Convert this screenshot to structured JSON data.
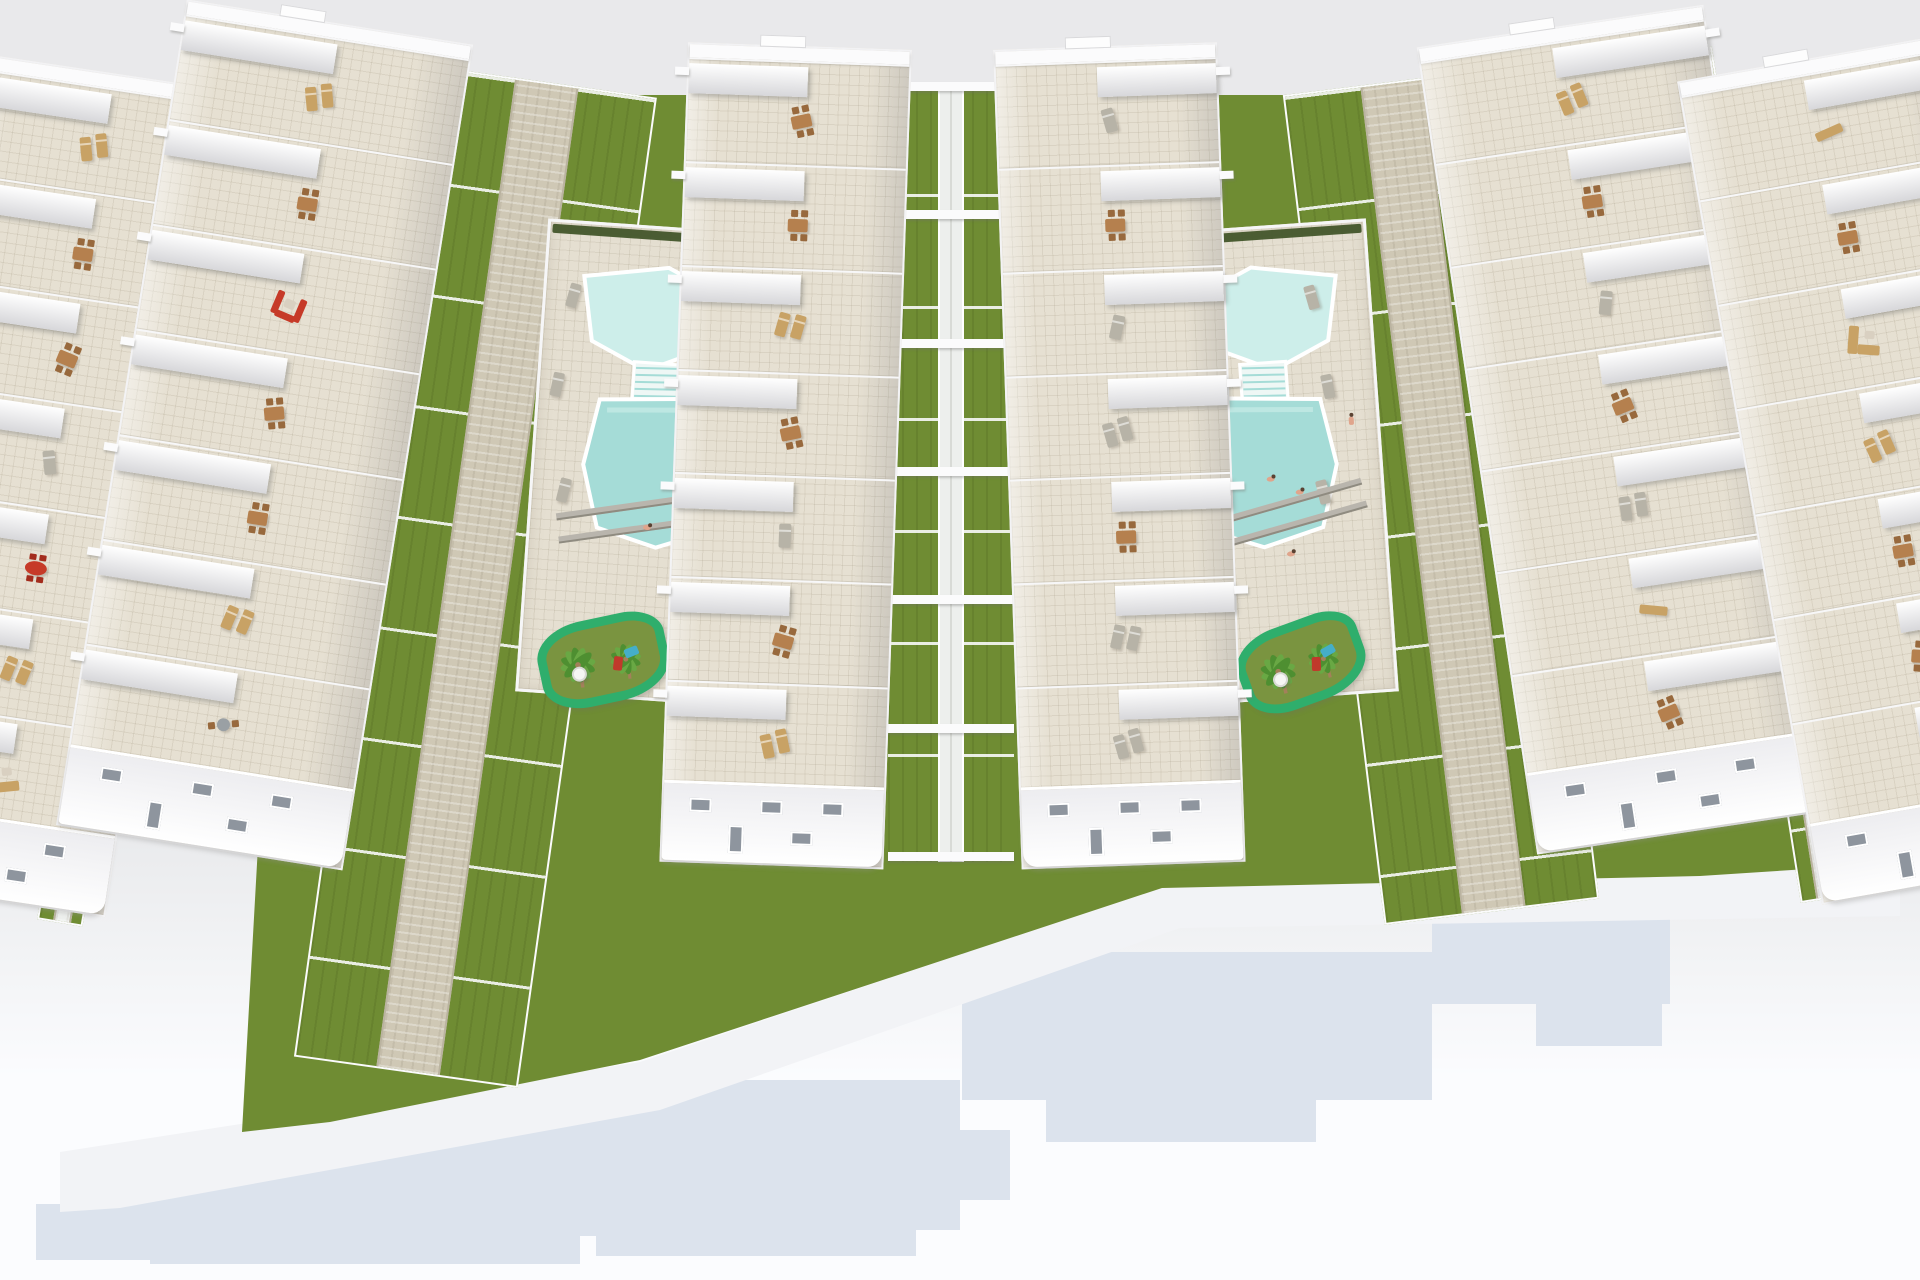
{
  "image": {
    "type": "3d_architectural_render",
    "subject": "Aerial 3D rendering of a new-build residential development: six rows of white terraced apartments with furnished roof terraces, communal lawn strips with stone paths, two turquoise swimming pools with bathers, sun loungers, palm trees and playgrounds, all on a white base casting a pale blue blocky shadow",
    "width_px": 1920,
    "height_px": 1280
  },
  "palette": {
    "bg_top": "#e9e9eb",
    "bg_bottom_from": "#e9eaec",
    "bg_bottom_to": "#fbfcfe",
    "platform": "#f2f3f6",
    "shadow": "#dce3ed",
    "grass": "#6f8c33",
    "grass_dark": "#5e7b2a",
    "path": "#cfc8b5",
    "path_edge": "#bab3a0",
    "walk_white": "#edefed",
    "deck": "#e5dfd1",
    "terrace": "#e6e0d2",
    "wall_white": "#fbfbfc",
    "wall_shade": "#d7d7da",
    "wall_dark": "#b4b4b8",
    "hedge": "#42552a",
    "pool_main": "#a5dcd7",
    "pool_light": "#cdeeea",
    "pool_steps": "#eef7f5",
    "playground_border": "#2fae6c",
    "playground_fill": "#7a9440",
    "palm_green": "#4e8f31",
    "palm_green2": "#69a844",
    "palm_trunk": "#a3805a",
    "furniture_brown": "#b5804e",
    "furniture_brown_dark": "#98693d",
    "furniture_red": "#c63a28",
    "furniture_red_dark": "#a32c1d",
    "lounger_gray": "#b7b3a7",
    "lounger_tan": "#c8a265",
    "bistro_gray": "#9aa0a4",
    "window": "#8e959e",
    "skin": "#e0a58c",
    "hair": "#5a4232",
    "equip_blue": "#45aec8",
    "equip_red": "#c0392b",
    "parasol_white": "#f6f6f4"
  },
  "scene": {
    "underlay_polygon": "300,95 1600,95 1868,865 1700,876 1162,888 640,1060 330,1122 242,1132",
    "platform_polygon": "60,1152 640,1062 1160,888 1900,868 1900,916 1180,928 660,1110 120,1208 60,1212",
    "shadow_rects": [
      [
        70,
        1158,
        600,
        78
      ],
      [
        36,
        1204,
        210,
        56
      ],
      [
        150,
        1236,
        430,
        28
      ],
      [
        310,
        1080,
        650,
        150
      ],
      [
        596,
        1230,
        320,
        26
      ],
      [
        250,
        1130,
        760,
        70
      ],
      [
        962,
        952,
        470,
        148
      ],
      [
        1046,
        1100,
        270,
        42
      ],
      [
        1432,
        894,
        238,
        110
      ],
      [
        1536,
        1004,
        126,
        42
      ]
    ],
    "building_rows": [
      {
        "id": "row-1",
        "x": -20,
        "y": 72,
        "w": 250,
        "h": 836,
        "rot": 8.5,
        "side": "left",
        "tab": false,
        "cells": [
          "loungers_tan",
          "dining",
          "dining",
          "lounger_single",
          "dining_red",
          "loungers_tan",
          "sofa_l_tan"
        ]
      },
      {
        "id": "row-2",
        "x": 185,
        "y": 22,
        "w": 290,
        "h": 836,
        "rot": 9,
        "side": "left",
        "tab": true,
        "cells": [
          "loungers_tan",
          "dining",
          "sofa_red",
          "dining",
          "dining",
          "loungers_tan",
          "bistro"
        ]
      },
      {
        "id": "row-3",
        "x": 688,
        "y": 46,
        "w": 224,
        "h": 820,
        "rot": 2,
        "side": "left",
        "tab": true,
        "cells": [
          "dining",
          "dining",
          "loungers_tan",
          "dining",
          "lounger_single",
          "dining",
          "loungers_tan"
        ]
      },
      {
        "id": "row-4",
        "x": 993,
        "y": 46,
        "w": 224,
        "h": 820,
        "rot": -2,
        "side": "right",
        "tab": true,
        "cells": [
          "lounger_single",
          "dining",
          "lounger_single",
          "loungers_gray",
          "dining",
          "loungers_gray",
          "loungers_gray"
        ]
      },
      {
        "id": "row-5",
        "x": 1415,
        "y": 26,
        "w": 290,
        "h": 816,
        "rot": -8.5,
        "side": "right",
        "tab": true,
        "cells": [
          "loungers_tan",
          "dining",
          "lounger_single",
          "dining",
          "loungers_gray",
          "bench",
          "dining"
        ]
      },
      {
        "id": "row-6",
        "x": 1675,
        "y": 58,
        "w": 272,
        "h": 836,
        "rot": -10,
        "side": "right",
        "tab": true,
        "cells": [
          "bench",
          "dining",
          "sofa_l_tan",
          "loungers_tan",
          "dining",
          "dining",
          "dining"
        ]
      }
    ],
    "garden_strips": [
      {
        "id": "garden-left",
        "x": 432,
        "y": 82,
        "w": 226,
        "h": 1000,
        "rot": 8,
        "path_w": 64,
        "path_color": "path"
      },
      {
        "id": "garden-right",
        "x": 1282,
        "y": 82,
        "w": 216,
        "h": 836,
        "rot": -7,
        "path_w": 64,
        "path_color": "path"
      },
      {
        "id": "gap-left",
        "x": 182,
        "y": 55,
        "w": 46,
        "h": 880,
        "rot": 9.5,
        "path_w": 18,
        "path_color": "walk_white"
      },
      {
        "id": "gap-right",
        "x": 1666,
        "y": 50,
        "w": 46,
        "h": 860,
        "rot": -9,
        "path_w": 18,
        "path_color": "walk_white"
      }
    ],
    "alley": {
      "x": 888,
      "y": 82,
      "w": 126,
      "h": 780,
      "rot": 0,
      "walk_w": 26,
      "bars": 7
    },
    "courtyards": [
      {
        "id": "courtyard-west",
        "x": 548,
        "y": 226,
        "w": 218,
        "h": 474,
        "rot": 4,
        "mirror": false,
        "people_pool": [
          [
            0.52,
            0.62
          ]
        ],
        "people_deck": [],
        "playground": {
          "cx": 0.38,
          "cy": 0.915,
          "w": 130,
          "h": 86
        }
      },
      {
        "id": "courtyard-east",
        "x": 1148,
        "y": 226,
        "w": 218,
        "h": 474,
        "rot": -4,
        "mirror": true,
        "people_pool": [
          [
            0.45,
            0.52
          ],
          [
            0.58,
            0.55
          ],
          [
            0.52,
            0.68
          ]
        ],
        "people_deck": [
          [
            0.84,
            0.4
          ]
        ],
        "playground": {
          "cx": 0.55,
          "cy": 0.92,
          "w": 128,
          "h": 84
        }
      }
    ],
    "counts": {
      "building_rows": 6,
      "apartment_blocks_per_row": 7,
      "pools": 2,
      "playgrounds": 2,
      "garden_paths": 2
    }
  }
}
